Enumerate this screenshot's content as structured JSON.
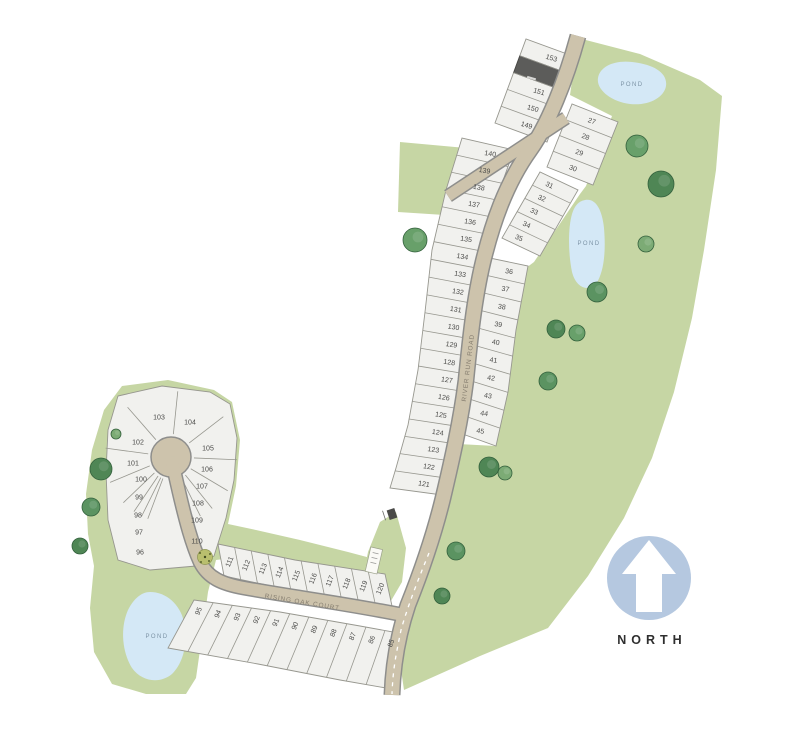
{
  "roads": {
    "river_run_road": "RIVER RUN ROAD",
    "rising_oak_court": "RISING OAK COURT"
  },
  "ponds": {
    "labels": [
      "POND",
      "POND",
      "POND"
    ]
  },
  "compass": {
    "label": "NORTH"
  },
  "lots": {
    "upper_west": [
      "153",
      "",
      "151",
      "150",
      "149"
    ],
    "upper_east": [
      "27",
      "28",
      "29",
      "30"
    ],
    "mid_east": [
      "31",
      "32",
      "33",
      "34",
      "35"
    ],
    "lower_east": [
      "36",
      "37",
      "38",
      "39",
      "40",
      "41",
      "42",
      "43",
      "44",
      "45"
    ],
    "river_west": [
      "140",
      "139",
      "138",
      "137",
      "136",
      "135",
      "134",
      "133",
      "132",
      "131",
      "130",
      "129",
      "128",
      "127",
      "126",
      "125",
      "124",
      "123",
      "122",
      "121"
    ],
    "culdesac_ring": [
      "96",
      "97",
      "98",
      "99",
      "100",
      "101",
      "102",
      "103",
      "104",
      "105",
      "106",
      "107",
      "108",
      "109",
      "110"
    ],
    "court_north": [
      "111",
      "112",
      "113",
      "114",
      "115",
      "116",
      "117",
      "118",
      "119",
      "120"
    ],
    "court_south": [
      "95",
      "94",
      "93",
      "92",
      "91",
      "90",
      "89",
      "88",
      "87",
      "86",
      "85"
    ]
  },
  "colors": {
    "parcel_green": "#c6d6a4",
    "lot_fill": "#f1f1ee",
    "lot_edge": "#97978f",
    "road_fill": "#cdc3ac",
    "road_edge": "#8e8e8c",
    "pond_fill": "#d4e8f6",
    "pond_text": "#7d94a6",
    "lot_text": "#4a4a48",
    "sold_lot": "#5c5c5a",
    "north_circle": "#b5c8e0",
    "north_text": "#2f2f2f"
  }
}
